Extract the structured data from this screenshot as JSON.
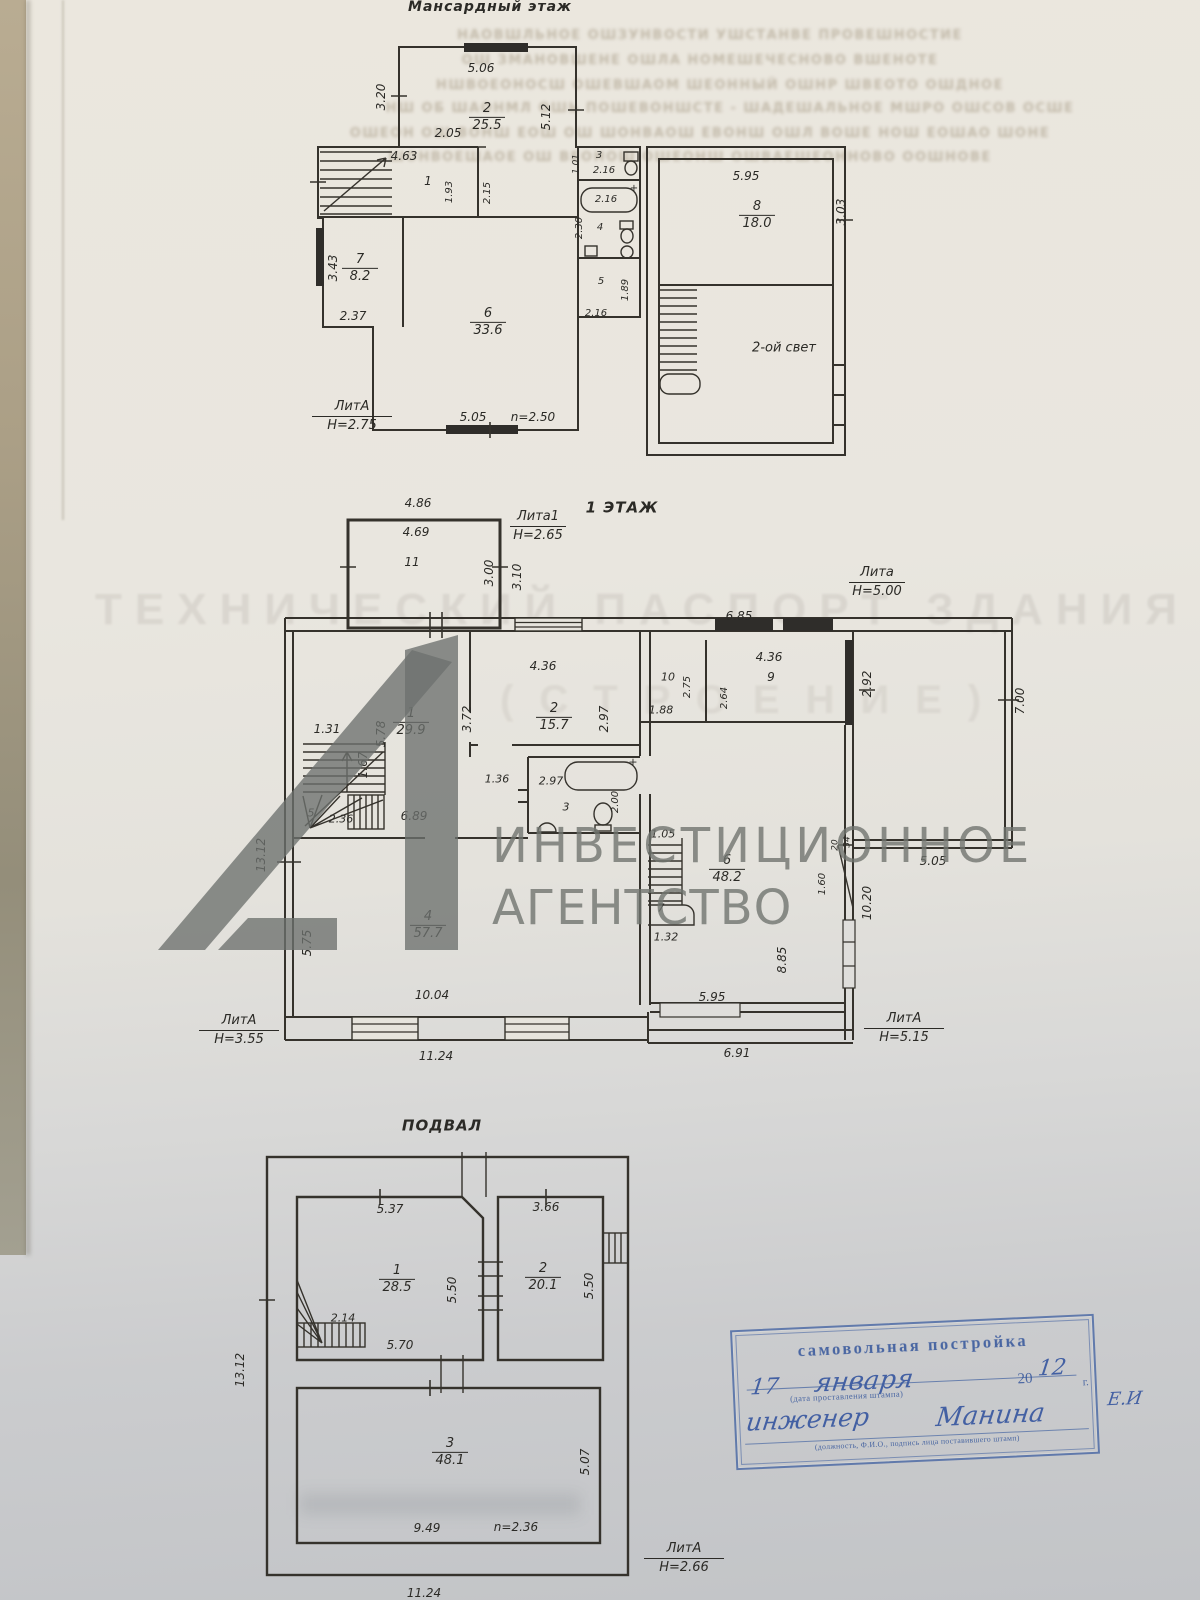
{
  "colors": {
    "ink": "#35322c",
    "stamp_blue": "#3f62a8",
    "watermark_gray": "#70746f",
    "paper_top": "#ebe7de",
    "paper_bottom": "#c2c4c7"
  },
  "bleed": {
    "lines": [
      {
        "t": "НАОВШЛЬНОЕ ОШЗУНВОСТИ УШСТАНВЕ ПРОВЕШНОСТИЕ",
        "x": 710,
        "y": 28
      },
      {
        "t": "ОШ ЗМАНОВШЕНЕ ОШЛА НОМЕШЕЧЕСНОВО ВШЕНОТЕ",
        "x": 700,
        "y": 53
      },
      {
        "t": "НШВОЕОНОСШ ОШЕВШАОМ ШЕОННЫЙ ОШНР ШВЕОТО ОШДНОЕ",
        "x": 720,
        "y": 78
      },
      {
        "t": "НШ ОБ ШАОНМЛ ОШЬ ПОШЕВОНШСТЕ - ШАДЕШАЛЬНОЕ МШРО ОШСОВ ОСШЕ",
        "x": 730,
        "y": 101
      },
      {
        "t": "ОШЕОН ОШ ВОНШ ЕОШ ОШ ШОНВАОШ ЕВОНШ ОШЛ ВОШЕ НОШ ЕОШАО ШОНЕ",
        "x": 700,
        "y": 126
      },
      {
        "t": "ШОНВОЕШАОЕ ОШ ВЕОНОШ ОШЕОНШ ОШВАЕШЕОННОВО ООШНОВЕ",
        "x": 690,
        "y": 150
      }
    ]
  },
  "ghost": {
    "title": "ТЕХНИЧЕСКИЙ ПАСПОРТ ЗДАНИЯ",
    "subtitle": "(СТРОЕНИЕ)"
  },
  "watermark": {
    "line1": "ИНВЕСТИЦИОННОЕ",
    "line2": "АГЕНТСТВО"
  },
  "plans": [
    {
      "name": "attic",
      "labels": [
        {
          "t": "Мансардный этаж",
          "x": 490,
          "y": 7,
          "k": "title",
          "s": 14
        },
        {
          "t": "5.06",
          "x": 481,
          "y": 68
        },
        {
          "t": "3.20",
          "x": 381,
          "y": 97,
          "r": 1
        },
        {
          "t": "5.12",
          "x": 546,
          "y": 117,
          "r": 1
        },
        {
          "t": "2.05",
          "x": 448,
          "y": 133
        },
        {
          "t": "4.63",
          "x": 404,
          "y": 156
        },
        {
          "t": "1",
          "x": 428,
          "y": 181
        },
        {
          "t": "1.93",
          "x": 450,
          "y": 192,
          "r": 1,
          "s": 10
        },
        {
          "t": "2.15",
          "x": 488,
          "y": 193,
          "r": 1,
          "s": 10
        },
        {
          "t": "1.01",
          "x": 577,
          "y": 164,
          "r": 1,
          "s": 9
        },
        {
          "t": "3",
          "x": 599,
          "y": 156,
          "s": 10
        },
        {
          "t": "2.16",
          "x": 604,
          "y": 171,
          "s": 10
        },
        {
          "t": "2.16",
          "x": 606,
          "y": 200,
          "s": 10
        },
        {
          "t": "+",
          "x": 634,
          "y": 189,
          "s": 10
        },
        {
          "t": "2.30",
          "x": 580,
          "y": 228,
          "r": 1,
          "s": 10
        },
        {
          "t": "4",
          "x": 600,
          "y": 228,
          "s": 10
        },
        {
          "t": "5",
          "x": 601,
          "y": 282,
          "s": 10
        },
        {
          "t": "1.89",
          "x": 626,
          "y": 290,
          "r": 1,
          "s": 10
        },
        {
          "t": "2.16",
          "x": 596,
          "y": 314,
          "s": 10
        },
        {
          "t": "3.43",
          "x": 333,
          "y": 268,
          "r": 1
        },
        {
          "t": "2.37",
          "x": 353,
          "y": 316
        },
        {
          "t": "5.05",
          "x": 473,
          "y": 417
        },
        {
          "t": "n=2.50",
          "x": 533,
          "y": 417
        },
        {
          "t": "5.95",
          "x": 746,
          "y": 176
        },
        {
          "t": "3.03",
          "x": 841,
          "y": 212,
          "r": 1
        },
        {
          "t": "2-ой свет",
          "x": 784,
          "y": 348,
          "s": 13
        }
      ],
      "rooms": [
        {
          "n": "2",
          "a": "25.5",
          "x": 487,
          "y": 117
        },
        {
          "n": "7",
          "a": "8.2",
          "x": 360,
          "y": 268
        },
        {
          "n": "6",
          "a": "33.6",
          "x": 488,
          "y": 322
        },
        {
          "n": "8",
          "a": "18.0",
          "x": 757,
          "y": 215
        }
      ],
      "lits": [
        {
          "lit": "ЛитА",
          "h": "Н=2.75",
          "x": 352,
          "y": 400,
          "w": 80
        }
      ]
    },
    {
      "name": "floor1",
      "labels": [
        {
          "t": "1 ЭТАЖ",
          "x": 622,
          "y": 508,
          "k": "title",
          "s": 15
        },
        {
          "t": "4.86",
          "x": 418,
          "y": 503
        },
        {
          "t": "4.69",
          "x": 416,
          "y": 532
        },
        {
          "t": "11",
          "x": 412,
          "y": 562
        },
        {
          "t": "3.00",
          "x": 489,
          "y": 573,
          "r": 1
        },
        {
          "t": "3.10",
          "x": 517,
          "y": 577,
          "r": 1
        },
        {
          "t": "6.85",
          "x": 739,
          "y": 616
        },
        {
          "t": "4.36",
          "x": 543,
          "y": 666
        },
        {
          "t": "3.72",
          "x": 467,
          "y": 719,
          "r": 1
        },
        {
          "t": "2.97",
          "x": 604,
          "y": 719,
          "r": 1
        },
        {
          "t": "1.31",
          "x": 327,
          "y": 729
        },
        {
          "t": "5.78",
          "x": 381,
          "y": 734,
          "r": 1
        },
        {
          "t": "1.67",
          "x": 363,
          "y": 765,
          "r": 1
        },
        {
          "t": "5",
          "x": 311,
          "y": 813,
          "s": 11
        },
        {
          "t": "2.36",
          "x": 341,
          "y": 819,
          "s": 11
        },
        {
          "t": "6.89",
          "x": 414,
          "y": 816
        },
        {
          "t": "1.36",
          "x": 497,
          "y": 779,
          "s": 11
        },
        {
          "t": "2.97",
          "x": 551,
          "y": 781,
          "s": 11
        },
        {
          "t": "+",
          "x": 633,
          "y": 762,
          "s": 11
        },
        {
          "t": "3",
          "x": 566,
          "y": 807,
          "s": 11
        },
        {
          "t": "2.00",
          "x": 616,
          "y": 802,
          "r": 1,
          "s": 10
        },
        {
          "t": "10",
          "x": 668,
          "y": 677,
          "s": 11
        },
        {
          "t": "2.75",
          "x": 688,
          "y": 687,
          "r": 1,
          "s": 10
        },
        {
          "t": "1.88",
          "x": 661,
          "y": 710,
          "s": 11
        },
        {
          "t": "4.36",
          "x": 769,
          "y": 657
        },
        {
          "t": "9",
          "x": 771,
          "y": 677
        },
        {
          "t": "2.64",
          "x": 725,
          "y": 698,
          "r": 1,
          "s": 10
        },
        {
          "t": "2.92",
          "x": 867,
          "y": 684,
          "r": 1
        },
        {
          "t": "7.00",
          "x": 1020,
          "y": 701,
          "r": 1
        },
        {
          "t": "5.05",
          "x": 933,
          "y": 861
        },
        {
          "t": "10.20",
          "x": 867,
          "y": 903,
          "r": 1
        },
        {
          "t": "1.05",
          "x": 663,
          "y": 834,
          "s": 11
        },
        {
          "t": "7",
          "x": 661,
          "y": 908,
          "s": 11
        },
        {
          "t": "1.32",
          "x": 666,
          "y": 937,
          "s": 11
        },
        {
          "t": "1.60",
          "x": 823,
          "y": 884,
          "r": 1,
          "s": 10
        },
        {
          "t": "20",
          "x": 836,
          "y": 845,
          "r": 1,
          "s": 9
        },
        {
          "t": "34",
          "x": 848,
          "y": 842,
          "r": 1,
          "s": 9
        },
        {
          "t": "8.85",
          "x": 782,
          "y": 960,
          "r": 1
        },
        {
          "t": "5.95",
          "x": 712,
          "y": 997
        },
        {
          "t": "5.75",
          "x": 307,
          "y": 943,
          "r": 1
        },
        {
          "t": "10.04",
          "x": 432,
          "y": 995
        },
        {
          "t": "11.24",
          "x": 436,
          "y": 1056
        },
        {
          "t": "13.12",
          "x": 261,
          "y": 855,
          "r": 1
        },
        {
          "t": "6.91",
          "x": 737,
          "y": 1053
        }
      ],
      "rooms": [
        {
          "n": "1",
          "a": "29.9",
          "x": 411,
          "y": 722
        },
        {
          "n": "2",
          "a": "15.7",
          "x": 554,
          "y": 717
        },
        {
          "n": "4",
          "a": "57.7",
          "x": 428,
          "y": 925
        },
        {
          "n": "6",
          "a": "48.2",
          "x": 727,
          "y": 869
        }
      ],
      "lits": [
        {
          "lit": "Лита1",
          "h": "Н=2.65",
          "x": 538,
          "y": 510,
          "w": 56
        },
        {
          "lit": "Лита",
          "h": "Н=5.00",
          "x": 877,
          "y": 566,
          "w": 56
        },
        {
          "lit": "ЛитА",
          "h": "Н=3.55",
          "x": 239,
          "y": 1014,
          "w": 80
        },
        {
          "lit": "ЛитА",
          "h": "Н=5.15",
          "x": 904,
          "y": 1012,
          "w": 80
        }
      ]
    },
    {
      "name": "basement",
      "labels": [
        {
          "t": "ПОДВАЛ",
          "x": 442,
          "y": 1126,
          "k": "title",
          "s": 15
        },
        {
          "t": "5.37",
          "x": 390,
          "y": 1209
        },
        {
          "t": "3.66",
          "x": 546,
          "y": 1207
        },
        {
          "t": "5.50",
          "x": 452,
          "y": 1290,
          "r": 1
        },
        {
          "t": "5.50",
          "x": 589,
          "y": 1286,
          "r": 1
        },
        {
          "t": "2.14",
          "x": 343,
          "y": 1318,
          "s": 11
        },
        {
          "t": "5.70",
          "x": 400,
          "y": 1345
        },
        {
          "t": "5.07",
          "x": 585,
          "y": 1462,
          "r": 1
        },
        {
          "t": "9.49",
          "x": 427,
          "y": 1528
        },
        {
          "t": "n=2.36",
          "x": 516,
          "y": 1527
        },
        {
          "t": "13.12",
          "x": 240,
          "y": 1370,
          "r": 1
        },
        {
          "t": "11.24",
          "x": 424,
          "y": 1593
        }
      ],
      "rooms": [
        {
          "n": "1",
          "a": "28.5",
          "x": 397,
          "y": 1279
        },
        {
          "n": "2",
          "a": "20.1",
          "x": 543,
          "y": 1277
        },
        {
          "n": "3",
          "a": "48.1",
          "x": 450,
          "y": 1452
        }
      ],
      "lits": [
        {
          "lit": "ЛитА",
          "h": "Н=2.66",
          "x": 684,
          "y": 1542,
          "w": 80
        }
      ]
    }
  ],
  "stamp": {
    "title": "самовольная постройка",
    "hw_day": "17",
    "hw_month": "января",
    "year_prefix": "20",
    "hw_year": "12",
    "year_suffix": "г.",
    "caption1": "(дата проставления штампа)",
    "hw_role": "инженер",
    "hw_name": "Манина",
    "hw_initials": "Е.И",
    "caption2": "(должность, Ф.И.О., подпись лица поставившего штамп)"
  }
}
